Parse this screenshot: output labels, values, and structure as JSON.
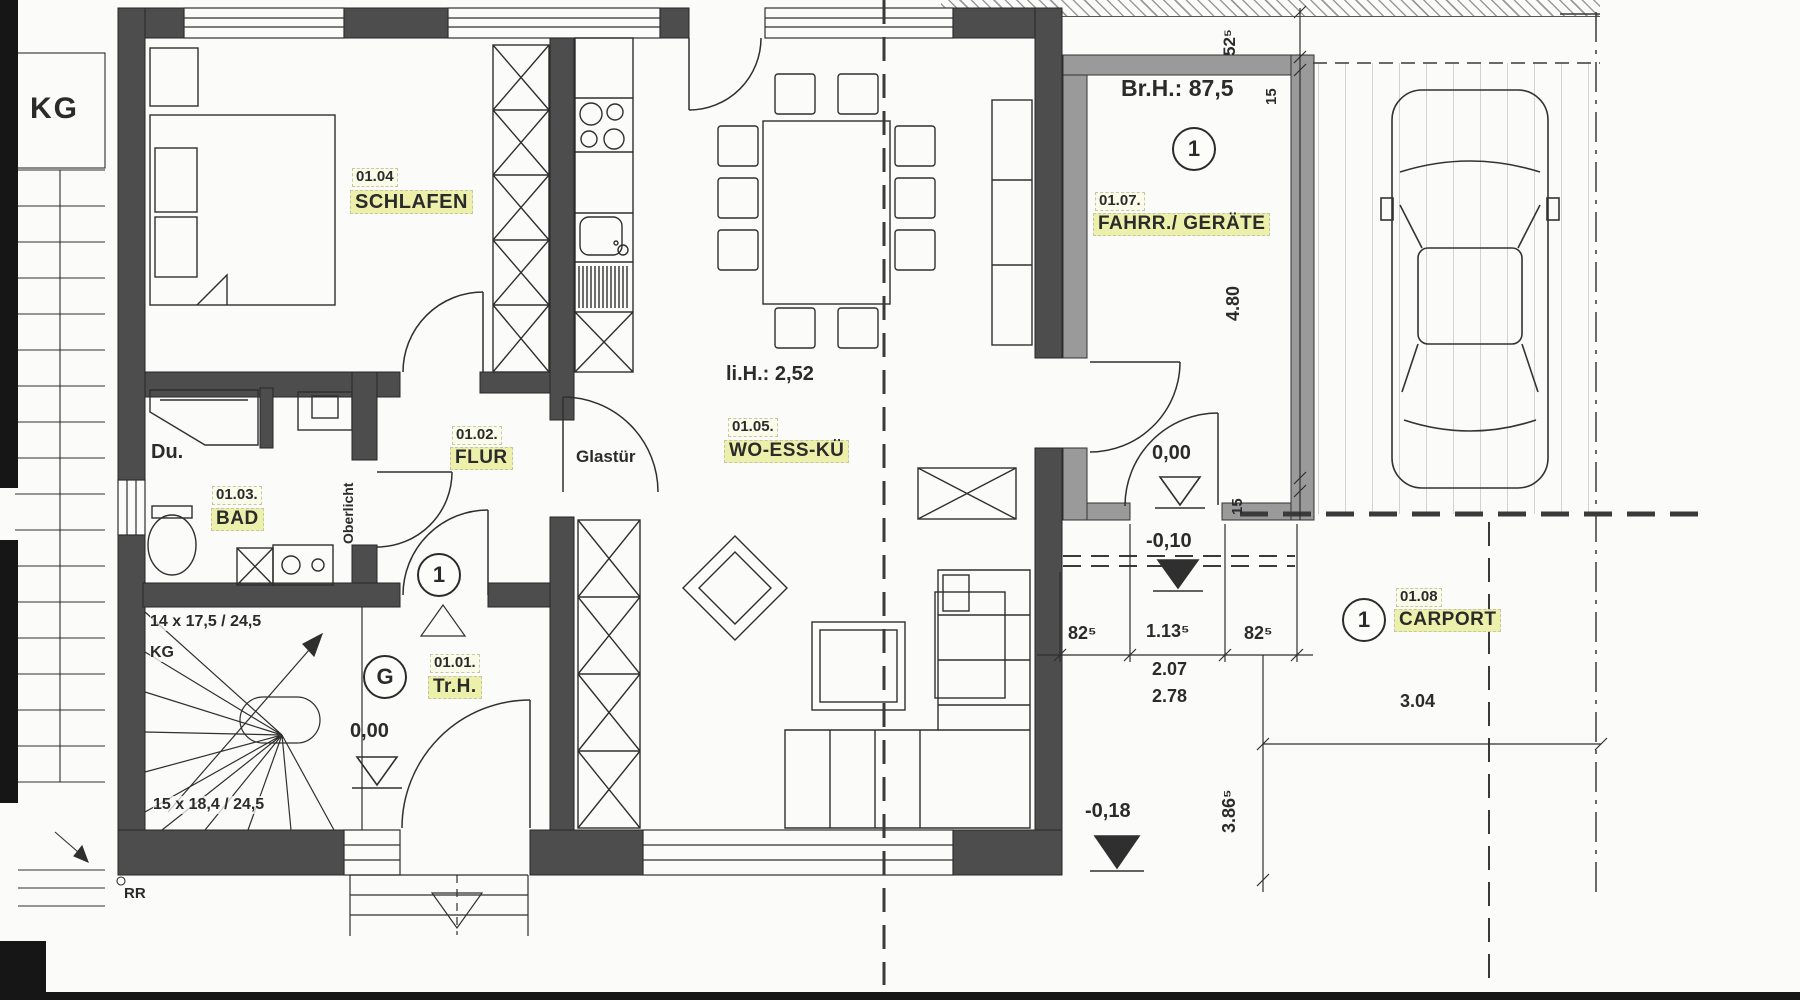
{
  "document": {
    "type": "scanned floor plan drawing"
  },
  "colors": {
    "paper": "#fbfbf9",
    "wall_dark": "#4d4d4d",
    "wall_garage": "#9a9a9a",
    "line": "#2f2f2f",
    "label_name_bg": "#edf0ab",
    "label_code_bg": "#fbfbea"
  },
  "rooms": {
    "trh": {
      "code": "01.01.",
      "name": "Tr.H."
    },
    "flur": {
      "code": "01.02.",
      "name": "FLUR"
    },
    "bad": {
      "code": "01.03.",
      "name": "BAD"
    },
    "schlafen": {
      "code": "01.04",
      "name": "SCHLAFEN"
    },
    "wohnen": {
      "code": "01.05.",
      "name": "WO-ESS-KÜ"
    },
    "geraete": {
      "code": "01.07.",
      "name": "FAHRR./ GERÄTE"
    },
    "carport": {
      "code": "01.08",
      "name": "CARPORT"
    }
  },
  "annotations": {
    "kg_big": "KG",
    "kg_small": "KG",
    "du": "Du.",
    "glastuer": "Glastür",
    "oberlicht": "Oberlicht",
    "lichte_hoehe": "li.H.: 2,52",
    "bruestung": "Br.H.: 87,5",
    "rr": "RR",
    "stair_upper": "14 x 17,5 / 24,5",
    "stair_lower": "15 x 18,4 / 24,5"
  },
  "levels": {
    "trh": "0,00",
    "garage": "0,00",
    "vor_garage": "-0,10",
    "terrasse": "-0,18"
  },
  "dims": {
    "v52": "52⁵",
    "v15_top": "15",
    "v480": "4.80",
    "v15_bottom": "15",
    "h82l": "82⁵",
    "h113": "1.13⁵",
    "h82r": "82⁵",
    "h207": "2.07",
    "h278": "2.78",
    "v386": "3.86⁵",
    "h304": "3.04"
  },
  "symbols": {
    "circle_1": "1",
    "circle_g": "G"
  }
}
